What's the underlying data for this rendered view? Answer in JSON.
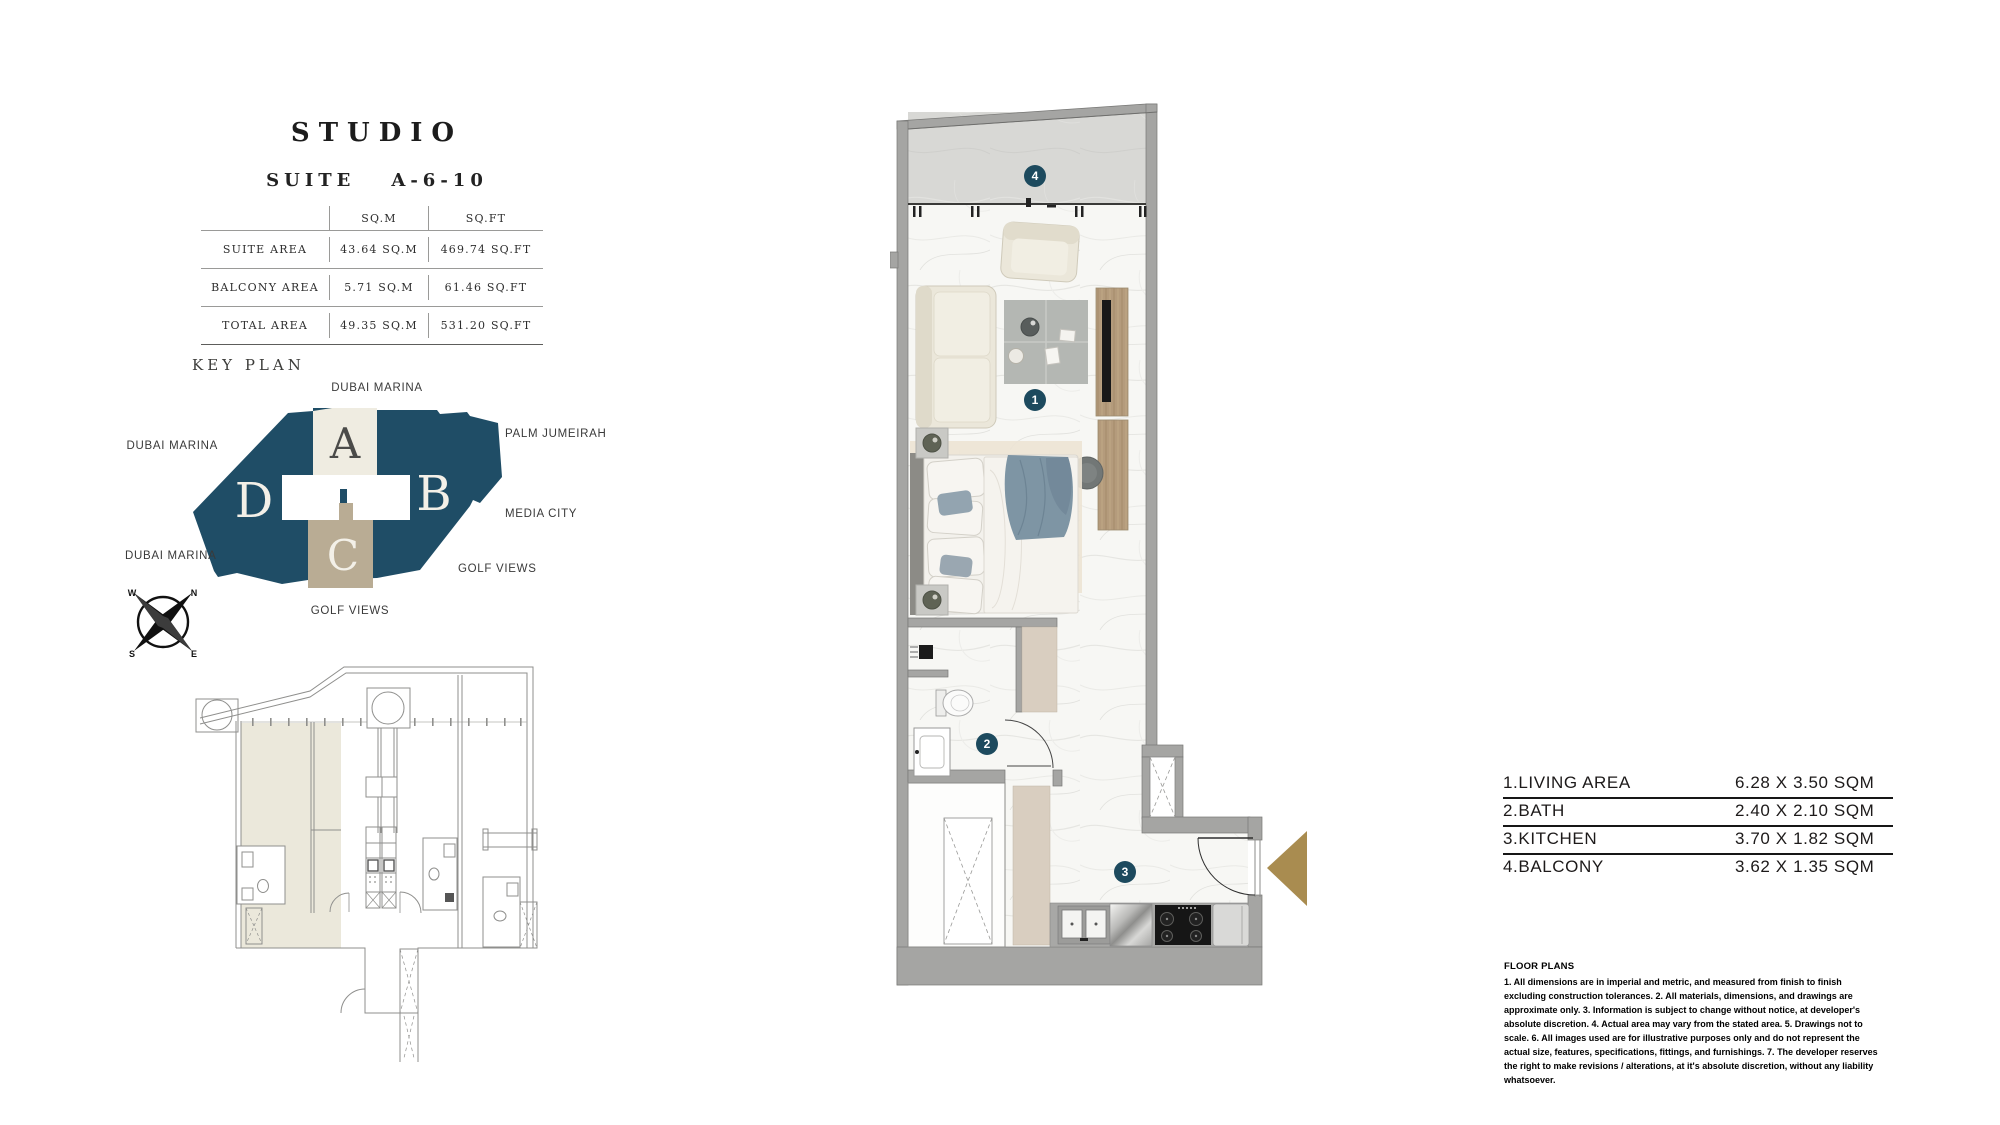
{
  "title": {
    "name": "STUDIO",
    "suite_label": "SUITE",
    "suite_number": "A-6-10"
  },
  "area_table": {
    "col_sqm": "SQ.M",
    "col_sqft": "SQ.FT",
    "rows": [
      {
        "label": "SUITE AREA",
        "sqm": "43.64 SQ.M",
        "sqft": "469.74 SQ.FT"
      },
      {
        "label": "BALCONY AREA",
        "sqm": "5.71 SQ.M",
        "sqft": "61.46 SQ.FT"
      },
      {
        "label": "TOTAL AREA",
        "sqm": "49.35 SQ.M",
        "sqft": "531.20 SQ.FT"
      }
    ]
  },
  "key_plan": {
    "heading": "KEY PLAN",
    "sections": {
      "a": "A",
      "b": "B",
      "c": "C",
      "d": "D"
    },
    "labels": {
      "top": "DUBAI MARINA",
      "left": "DUBAI MARINA",
      "bottom_left": "DUBAI MARINA",
      "right_top": "PALM JUMEIRAH",
      "right_mid": "MEDIA CITY",
      "right_bottom": "GOLF VIEWS",
      "bottom": "GOLF VIEWS"
    },
    "colors": {
      "tower": "#1f4d66",
      "section_a": "#efece1",
      "section_c": "#b9ac94"
    }
  },
  "compass": {
    "n": "N",
    "e": "E",
    "s": "S",
    "w": "W"
  },
  "plan": {
    "markers": {
      "living": "1",
      "bath": "2",
      "kitchen": "3",
      "balcony": "4"
    },
    "marker_color": "#1d4a5e",
    "entry_arrow_color": "#a98c50"
  },
  "legend": {
    "rows": [
      {
        "label": "1.LIVING AREA",
        "dims": "6.28 X 3.50 SQM"
      },
      {
        "label": "2.BATH",
        "dims": "2.40 X 2.10 SQM"
      },
      {
        "label": "3.KITCHEN",
        "dims": "3.70 X 1.82 SQM"
      },
      {
        "label": "4.BALCONY",
        "dims": "3.62 X 1.35 SQM"
      }
    ]
  },
  "disclaimer": {
    "title": "FLOOR PLANS",
    "body": "1. All dimensions are in imperial and metric, and measured from finish to finish excluding construction tolerances. 2. All materials, dimensions, and drawings are approximate only. 3. Information is subject to change without notice, at developer's absolute discretion. 4. Actual area may vary from the stated area. 5. Drawings not to scale. 6. All images used are for illustrative purposes only and do not represent the actual size, features, specifications, fittings, and furnishings. 7. The developer reserves the right to make revisions / alterations, at it's absolute discretion, without any liability whatsoever."
  }
}
